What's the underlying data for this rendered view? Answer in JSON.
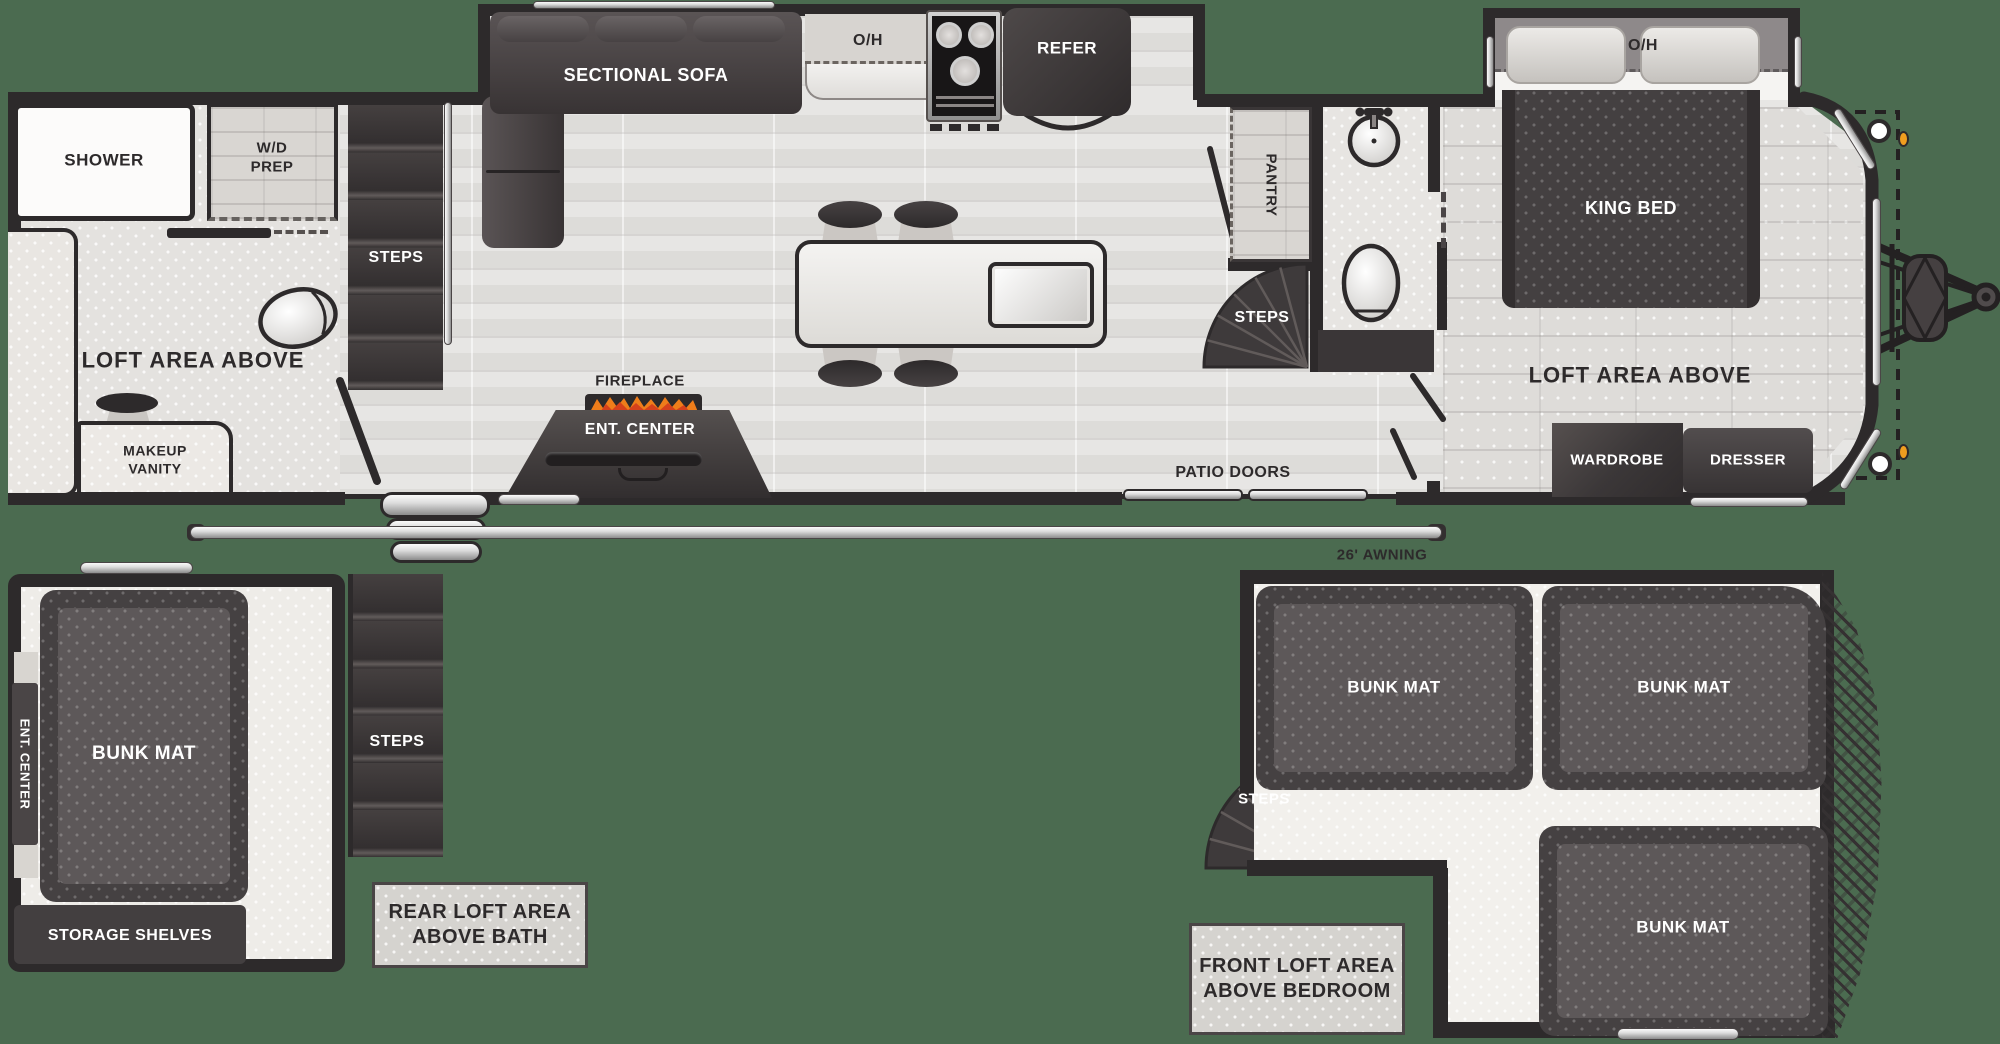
{
  "title": "RV destination-trailer floor plan with front and rear lofts",
  "colors": {
    "background": "#4b6b50",
    "wall": "#2d2a2b",
    "furniture_dark": "#3b3738",
    "floor_light": "#e0dfdd",
    "loft_floor": "#efede9",
    "label_box": "#d5d3cf",
    "silver": "#dcdcdc",
    "marker_light": "#ef9e1f",
    "flame_orange": "#ef7d1a",
    "flame_red": "#d6411c"
  },
  "main": {
    "rear": {
      "shower": "SHOWER",
      "wd_prep": "W/D\nPREP",
      "steps": "STEPS",
      "loft_area": "LOFT AREA ABOVE",
      "makeup_vanity": "MAKEUP\nVANITY"
    },
    "kitchen": {
      "sectional_sofa": "SECTIONAL SOFA",
      "overhead": "O/H",
      "refer": "REFER"
    },
    "living": {
      "fireplace": "FIREPLACE",
      "ent_center": "ENT. CENTER",
      "patio_doors": "PATIO DOORS"
    },
    "mid_bath": {
      "pantry": "PANTRY",
      "steps": "STEPS"
    },
    "bedroom": {
      "overhead": "O/H",
      "king_bed": "KING BED",
      "loft_area": "LOFT AREA ABOVE",
      "wardrobe": "WARDROBE",
      "dresser": "DRESSER"
    },
    "awning": "26' AWNING"
  },
  "rear_loft": {
    "ent_center": "ENT. CENTER",
    "bunk_mat": "BUNK MAT",
    "storage_shelves": "STORAGE SHELVES",
    "steps": "STEPS",
    "caption": "REAR LOFT AREA\nABOVE BATH"
  },
  "front_loft": {
    "bunk_mat_left": "BUNK MAT",
    "bunk_mat_right": "BUNK MAT",
    "bunk_mat_lower": "BUNK MAT",
    "steps": "STEPS",
    "caption": "FRONT LOFT AREA\nABOVE BEDROOM"
  }
}
